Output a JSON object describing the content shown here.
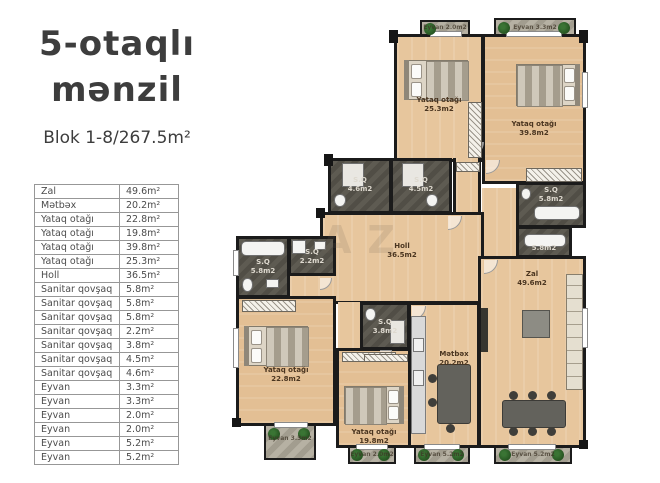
{
  "header": {
    "title_line1": "5-otaqlı",
    "title_line2": "mənzil",
    "subtitle": "Blok 1-8/267.5m²"
  },
  "table": {
    "rows": [
      {
        "label": "Zal",
        "area": "49.6m²"
      },
      {
        "label": "Mətbəx",
        "area": "20.2m²"
      },
      {
        "label": "Yataq otağı",
        "area": "22.8m²"
      },
      {
        "label": "Yataq otağı",
        "area": "19.8m²"
      },
      {
        "label": "Yataq otağı",
        "area": "39.8m²"
      },
      {
        "label": "Yataq otağı",
        "area": "25.3m²"
      },
      {
        "label": "Holl",
        "area": "36.5m²"
      },
      {
        "label": "Sanitar qovşaq",
        "area": "5.8m²"
      },
      {
        "label": "Sanitar qovşaq",
        "area": "5.8m²"
      },
      {
        "label": "Sanitar qovşaq",
        "area": "5.8m²"
      },
      {
        "label": "Sanitar qovşaq",
        "area": "2.2m²"
      },
      {
        "label": "Sanitar qovşaq",
        "area": "3.8m²"
      },
      {
        "label": "Sanitar qovşaq",
        "area": "4.5m²"
      },
      {
        "label": "Sanitar qovşaq",
        "area": "4.6m²"
      },
      {
        "label": "Eyvan",
        "area": "3.3m²"
      },
      {
        "label": "Eyvan",
        "area": "3.3m²"
      },
      {
        "label": "Eyvan",
        "area": "2.0m²"
      },
      {
        "label": "Eyvan",
        "area": "2.0m²"
      },
      {
        "label": "Eyvan",
        "area": "5.2m²"
      },
      {
        "label": "Eyvan",
        "area": "5.2m²"
      }
    ]
  },
  "plan": {
    "watermark": "AZ",
    "rooms": {
      "bedroom_tl": {
        "name": "Yataq otağı",
        "area": "25.3m2"
      },
      "bedroom_tr": {
        "name": "Yataq otağı",
        "area": "39.8m2"
      },
      "bedroom_left": {
        "name": "Yataq otağı",
        "area": "22.8m2"
      },
      "bedroom_mid": {
        "name": "Yataq otağı",
        "area": "19.8m2"
      },
      "hall": {
        "name": "Holl",
        "area": "36.5m2"
      },
      "kitchen": {
        "name": "Mətbəx",
        "area": "20.2m2"
      },
      "living": {
        "name": "Zal",
        "area": "49.6m2"
      },
      "sq_left": {
        "name": "S.Q",
        "area": "5.8m2"
      },
      "sq_small": {
        "name": "S.Q",
        "area": "2.2m2"
      },
      "sq_mid": {
        "name": "S.Q",
        "area": "3.8m2"
      },
      "sq_band_a": {
        "name": "S.Q",
        "area": "4.6m2"
      },
      "sq_band_b": {
        "name": "S.Q",
        "area": "4.5m2"
      },
      "sq_right_a": {
        "name": "S.Q",
        "area": "5.8m2"
      },
      "sq_right_b": {
        "name": "S.Q",
        "area": "5.8m2"
      },
      "balcony_top_a": {
        "name": "Eyvan",
        "area": "2.0m2"
      },
      "balcony_top_b": {
        "name": "Eyvan",
        "area": "3.3m2"
      },
      "balcony_b1": {
        "name": "Eyvan",
        "area": "3.3m2"
      },
      "balcony_b2": {
        "name": "Eyvan",
        "area": "2.0m2"
      },
      "balcony_b3": {
        "name": "Eyvan",
        "area": "5.2m2"
      },
      "balcony_b4": {
        "name": "Eyvan",
        "area": "5.2m2"
      }
    }
  }
}
